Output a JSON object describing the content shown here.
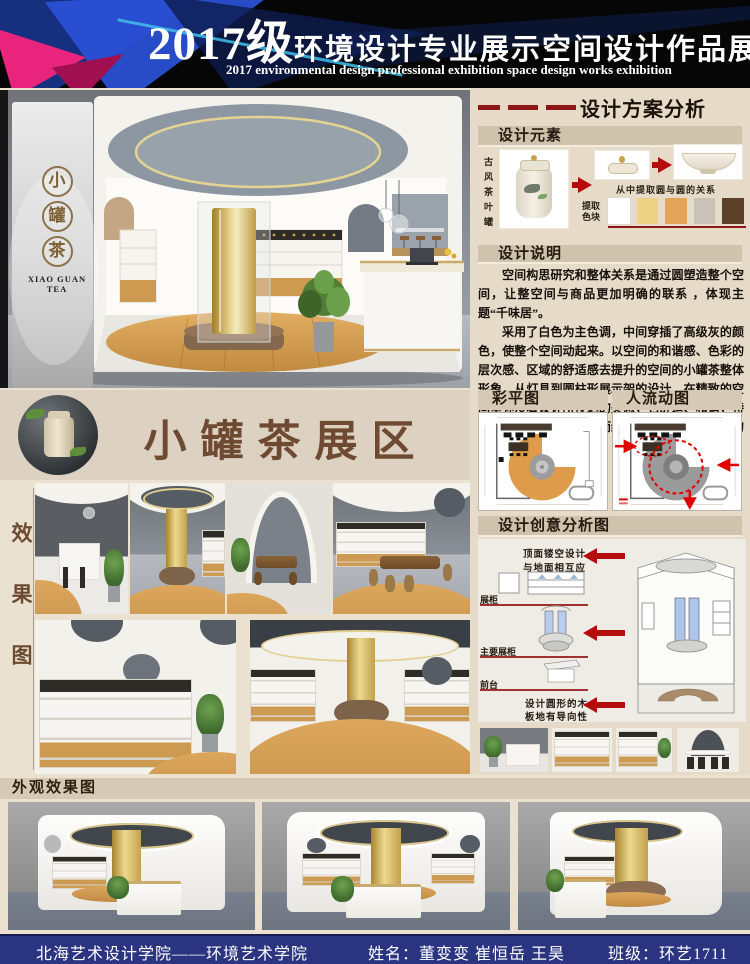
{
  "header": {
    "year": "2017级",
    "title_cn": "环境设计专业展示空间设计作品展",
    "subtitle_en": "2017 environmental design professional exhibition space design works exhibition"
  },
  "main_render": {
    "logo_chars": [
      "小",
      "罐",
      "茶"
    ],
    "logo_latin": "XIAO GUAN TEA"
  },
  "analysis": {
    "title": "设计方案分析",
    "elements": {
      "title": "设计元素",
      "vertical_label": "古风茶叶罐",
      "caption": "从中提取圆与圆的关系",
      "palette_label": "提取色块",
      "palette": [
        "#ffffff",
        "#ecd384",
        "#e3a457",
        "#c9c2b8",
        "#5b4128"
      ]
    },
    "description": {
      "title": "设计说明",
      "para1": "空间构思研究和整体关系是通过圆塑造整个空间，让整空间与商品更加明确的联系 ，体现主题“千味居”。",
      "para2": "采用了白色为主色调，中间穿插了高级灰的颜色，使整个空间动起来。以空间的和谐感、色彩的层次感、区域的舒适感去提升的空间的小罐茶整体形象。从灯具到圆柱形展示架的设计，在精致的空间里弥漫着设计所传达的美感，它舒适、和谐，特别而不张扬，品味高雅而经典，严谨中透出细部的优雅。"
    },
    "plans": {
      "color_title": "彩平图",
      "flow_title": "人流动图"
    },
    "creative": {
      "title": "设计创意分析图",
      "note_top_1": "顶面镂空设计",
      "note_top_2": "与地面相互应",
      "label_showcase": "展柜",
      "label_main_showcase": "主要展柜",
      "label_front_desk": "前台",
      "note_bottom_1": "设计圆形的木",
      "note_bottom_2": "板地有导向性"
    }
  },
  "banner": {
    "title": "小罐茶展区"
  },
  "gallery": {
    "vertical_label": "效果图"
  },
  "exterior": {
    "title": "外观效果图"
  },
  "footer": {
    "school": "北海艺术设计学院——环境艺术学院",
    "names": "姓名：董变变  崔恒岳  王昊",
    "class": "班级：环艺1711"
  },
  "colors": {
    "accent_red": "#8e1616",
    "arrow_red": "#b50d0d",
    "footer_bg": "#2a3480",
    "title_brown": "#6f4a32",
    "gold": "#c9a84c",
    "wood": "#cd9a52"
  }
}
